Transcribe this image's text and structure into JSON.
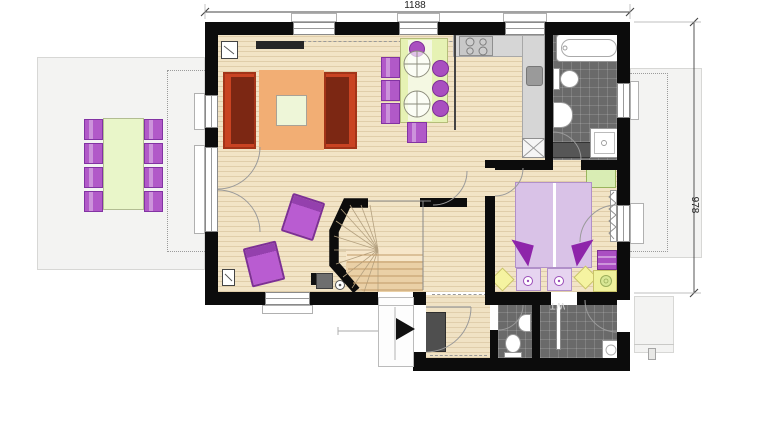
{
  "plan": {
    "dimension_labels": {
      "top": "1188",
      "right": "978"
    },
    "room_labels": {
      "utility": "WT"
    },
    "colors": {
      "wall": "#0c0c0c",
      "wood_floor": "#f2e4c6",
      "tile_floor": "#6a6a6a",
      "terrace": "#f3f3f2",
      "sofa_red": "#c94322",
      "rug_orange": "#f2ae74",
      "furniture_purple": "#b159c8",
      "table_green": "#e9f6c9",
      "bed_lavender": "#d9c2e7",
      "accent_yellow": "#f5f3a1",
      "stair_wood": "#ead0a6"
    }
  }
}
